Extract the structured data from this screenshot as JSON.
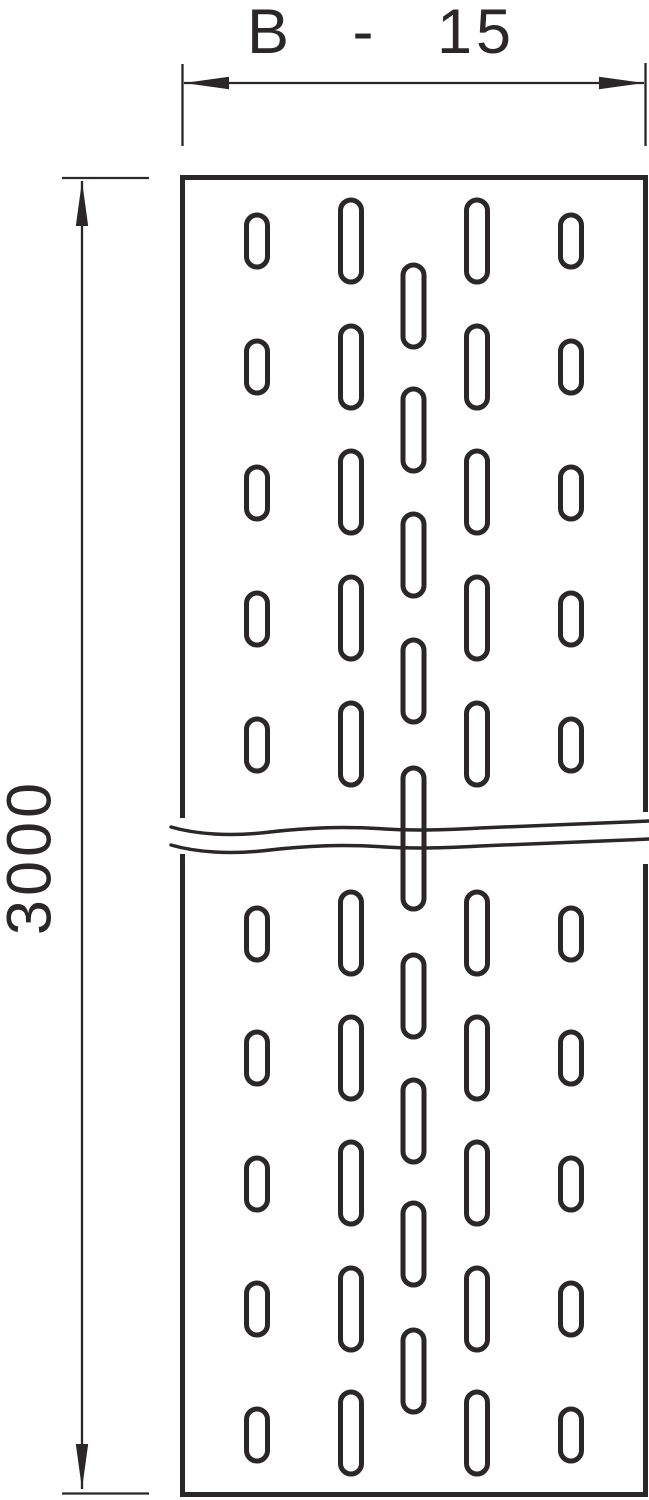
{
  "colors": {
    "background": "#ffffff",
    "line": "#2b2627"
  },
  "dimensions": {
    "width": {
      "label": "B - 15"
    },
    "length": {
      "label": "3000"
    }
  },
  "diagram": {
    "plate": {
      "x": 182.5,
      "y": 177.5,
      "width": 463,
      "height": 1317
    },
    "slots": {
      "width": 21,
      "short_height": 52,
      "long_height": 82,
      "columns": [
        {
          "name": "outer-left",
          "cx": 257,
          "type": "short",
          "tops": [
            215,
            341,
            467,
            593,
            719,
            908,
            1032,
            1158,
            1283,
            1409
          ]
        },
        {
          "name": "inner-left",
          "cx": 351,
          "type": "long",
          "tops": [
            200,
            326,
            451,
            577,
            703,
            892,
            1017,
            1142,
            1268,
            1392
          ]
        },
        {
          "name": "center",
          "cx": 413.5,
          "type": "long",
          "tops": [
            265,
            389,
            514,
            640,
            955,
            1080,
            1203,
            1330
          ],
          "break_slot": {
            "top": 768,
            "height": 141
          }
        },
        {
          "name": "inner-right",
          "cx": 477,
          "type": "long",
          "tops": [
            200,
            326,
            451,
            577,
            703,
            892,
            1017,
            1142,
            1268,
            1392
          ]
        },
        {
          "name": "outer-right",
          "cx": 571,
          "type": "short",
          "tops": [
            215,
            341,
            467,
            593,
            719,
            908,
            1032,
            1158,
            1283,
            1409
          ]
        }
      ]
    }
  }
}
